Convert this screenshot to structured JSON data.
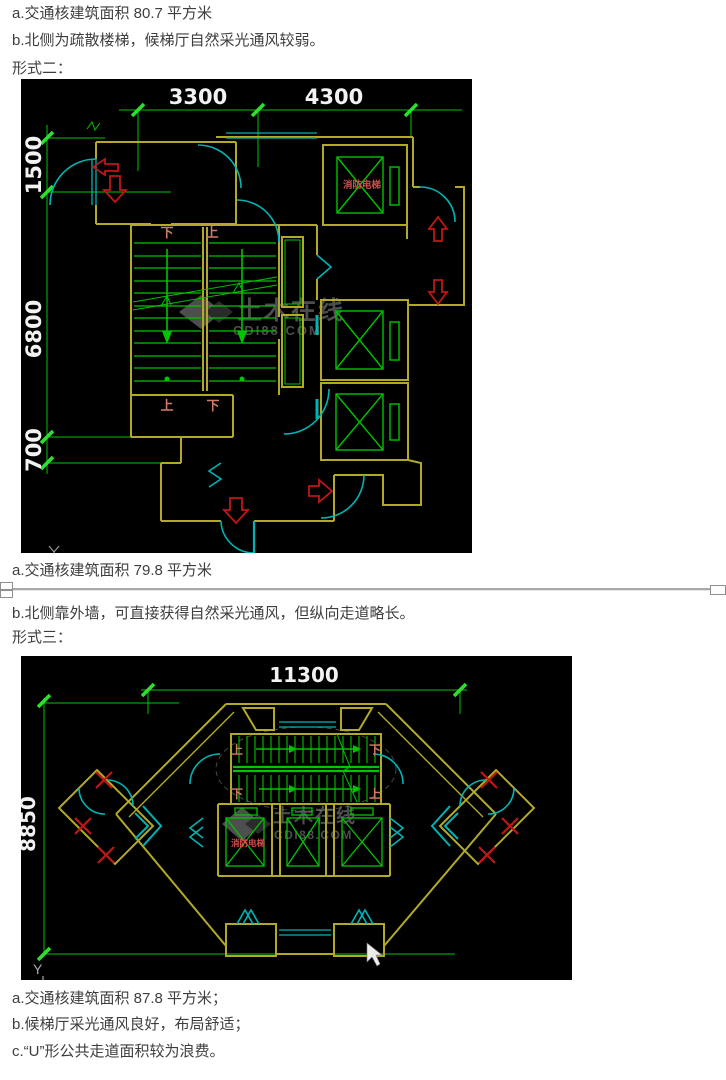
{
  "page": {
    "background": "#ffffff",
    "text_color": "#3e3e3e"
  },
  "sections": {
    "block1": {
      "line_a": "a.交通核建筑面积 80.7 平方米",
      "line_b": "b.北侧为疏散楼梯，候梯厅自然采光通风较弱。",
      "heading": "形式二："
    },
    "block2": {
      "line_a": "a.交通核建筑面积 79.8 平方米",
      "line_b": "b.北侧靠外墙，可直接获得自然采光通风，但纵向走道略长。",
      "heading": "形式三："
    },
    "block3": {
      "line_a": "a.交通核建筑面积 87.8 平方米；",
      "line_b": "b.候梯厅采光通风良好，布局舒适；",
      "line_c": "c.“U”形公共走道面积较为浪费。"
    }
  },
  "figure1": {
    "dim_top_1": "3300",
    "dim_top_2": "4300",
    "dim_left_1": "1500",
    "dim_left_2": "6800",
    "dim_left_3": "700",
    "fire_elevator": "消防电梯",
    "stair_top_left": "下",
    "stair_top_right": "上",
    "stair_bottom_left": "上",
    "stair_bottom_right": "下",
    "watermark_name": "土木在线",
    "watermark_site": "CDI88.COM"
  },
  "figure2": {
    "dim_top": "11300",
    "dim_left": "8850",
    "fire_elevator": "消防电梯",
    "stair_up_left": "上",
    "stair_down_right": "下",
    "stair_down_left": "下",
    "stair_up_right": "上",
    "axis_label": "Y",
    "watermark_name": "土木在线",
    "watermark_site": "CDI88.COM"
  },
  "cad_colors": {
    "background": "#000000",
    "wall_yellow": "#b2aa26",
    "dimension_green": "#00c400",
    "tick_green": "#2ee02e",
    "door_cyan": "#00b4b4",
    "arrow_red": "#c01616",
    "stair_label_salmon": "#cf7a66",
    "dim_text_white": "#f2f2f2",
    "watermark_gray": "#909090"
  }
}
